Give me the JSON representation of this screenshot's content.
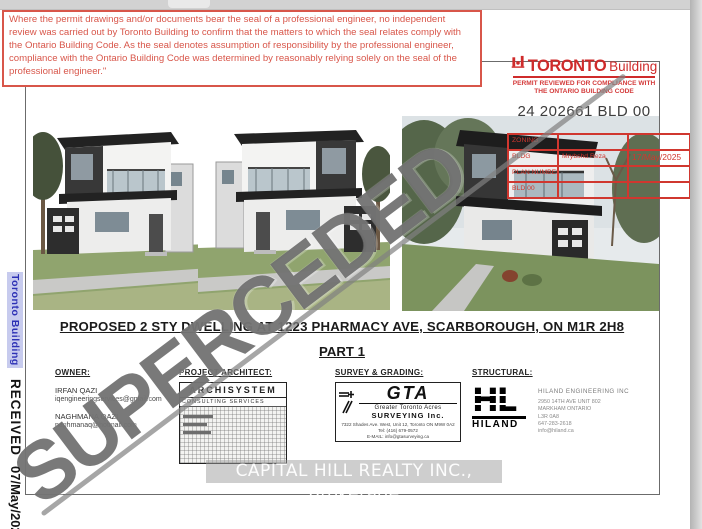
{
  "page": {
    "disclaimer": "Where the permit drawings and/or documents bear the seal of a professional engineer, no independent review was carried out by Toronto Building to confirm that the matters to which the seal relates comply with the Ontario Building Code. As the seal denotes assumption of responsibility by the professional engineer, compliance with the Ontario Building Code was determined by reasonably relying solely on the seal of the professional engineer.\"",
    "watermark": "SUPERCEDED",
    "title_line1": "PROPOSED 2 STY DWELLING AT 1223 PHARMACY AVE, SCARBOROUGH, ON M1R 2H8",
    "title_line2": "PART 1"
  },
  "toronto_building": {
    "name_bold": "TORONTO",
    "name_light": "Building",
    "tagline_line1": "PERMIT REVIEWED FOR COMPLIANCE WITH",
    "tagline_line2": "THE ONTARIO BUILDING CODE",
    "permit_number": "24 202661 BLD 00"
  },
  "stamp_table": {
    "rows": [
      {
        "label": "ZONING",
        "name": "",
        "date": ""
      },
      {
        "label": "BLDG",
        "name": "Mrybshd Reza",
        "date": "17/May/2025"
      },
      {
        "label": "PLAN NUMBERS",
        "name": "",
        "date": ""
      },
      {
        "label": "BLD 00",
        "name": "",
        "date": ""
      }
    ]
  },
  "sidebar": {
    "logo_text": "Toronto Building",
    "received_label": "RECEIVED",
    "received_date": "07/May/2025"
  },
  "sections": {
    "owner": {
      "label": "OWNER:",
      "contacts": [
        {
          "name": "IRFAN QAZI",
          "email": "iqengineeringservices@gmail.com"
        },
        {
          "name": "NAGHMANA QAZI",
          "email": "naghmanaq@hotmail.com"
        }
      ]
    },
    "architect": {
      "label": "PROJECT ARCHITECT:",
      "firm": "ARCHISYSTEM",
      "line2": "CONSULTING SERVICES"
    },
    "survey": {
      "label": "SURVEY & GRADING:",
      "logo": "GTA",
      "firm_line1": "Greater Toronto Acres",
      "firm_line2": "SURVEYING Inc.",
      "address": "7322 Shades Ave. West, Unit 12, Toronto ON M9W 0A2",
      "tel": "Tel: (416) 679-0572",
      "email": "E-MAIL: info@gtasurveying.ca"
    },
    "structural": {
      "label": "STRUCTURAL:",
      "logo": "HL",
      "logo_caption": "HILAND",
      "firm": "HILAND ENGINEERING INC",
      "address_line1": "2950 14TH AVE UNIT 802",
      "address_line2": "MARKHAM ONTARIO",
      "address_line3": "L3R 0A8",
      "address_line4": "647-283-2618",
      "address_line5": "info@hiland.ca"
    }
  },
  "footer": {
    "realty": "CAPITAL HILL REALTY INC., Brokerage"
  },
  "colors": {
    "accent_red": "#d8564a",
    "logo_red": "#cf2b2b",
    "stamp_red": "#d0372f",
    "watermark_gray": "#626262",
    "sidebar_blue": "#2d31b5",
    "sidebar_highlight": "#c7cbee"
  }
}
